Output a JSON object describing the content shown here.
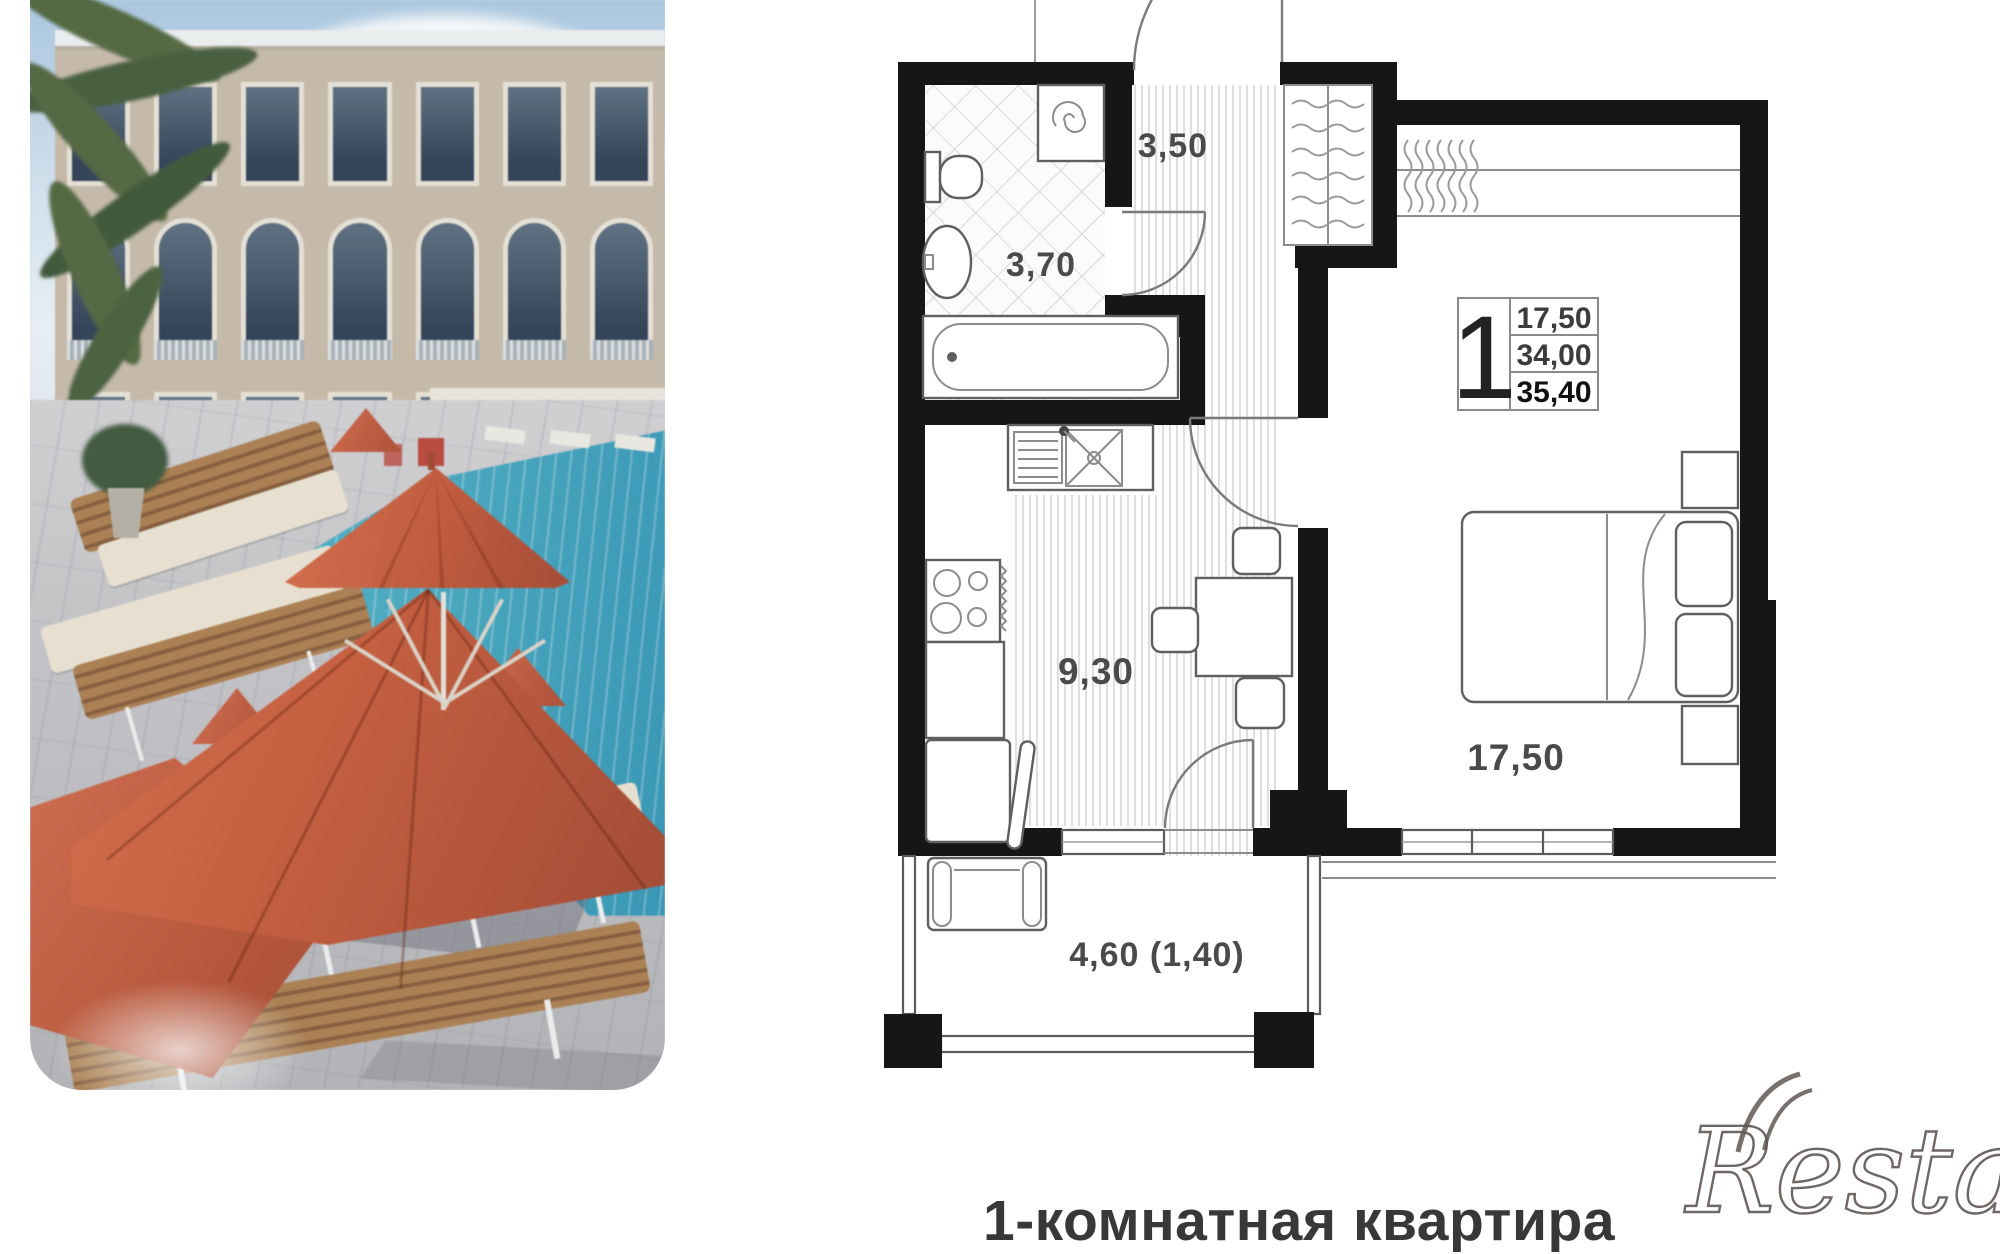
{
  "photo_card": {
    "scene": "resort pool with apartment building",
    "colors": {
      "umbrella": "#cc5a3a",
      "pool": "#45b0c6",
      "building": "#c8bbaa",
      "deck": "#c3c3c7",
      "palm": "#4e6a49",
      "lounger_wood": "#a5794c",
      "lounger_cushion": "#eae2d2"
    }
  },
  "floorplan": {
    "wall_color": "#161616",
    "area_labels": {
      "hall": "3,50",
      "bathroom": "3,70",
      "kitchen": "9,30",
      "room": "17,50",
      "balcony": "4,60 (1,40)"
    },
    "info_box": {
      "rooms": "1",
      "rows": [
        "17,50",
        "34,00",
        "35,40"
      ]
    },
    "furniture": [
      "bathtub",
      "toilet",
      "wash-basin",
      "washing-machine",
      "wardrobe",
      "bed",
      "nightstand",
      "dining-table",
      "chair",
      "stove",
      "kitchen-sink",
      "fridge",
      "armchair",
      "window",
      "door"
    ]
  },
  "caption": {
    "text": "1-комнатная квартира"
  },
  "watermark": {
    "text": "Restate",
    "color": "#5f5753"
  }
}
